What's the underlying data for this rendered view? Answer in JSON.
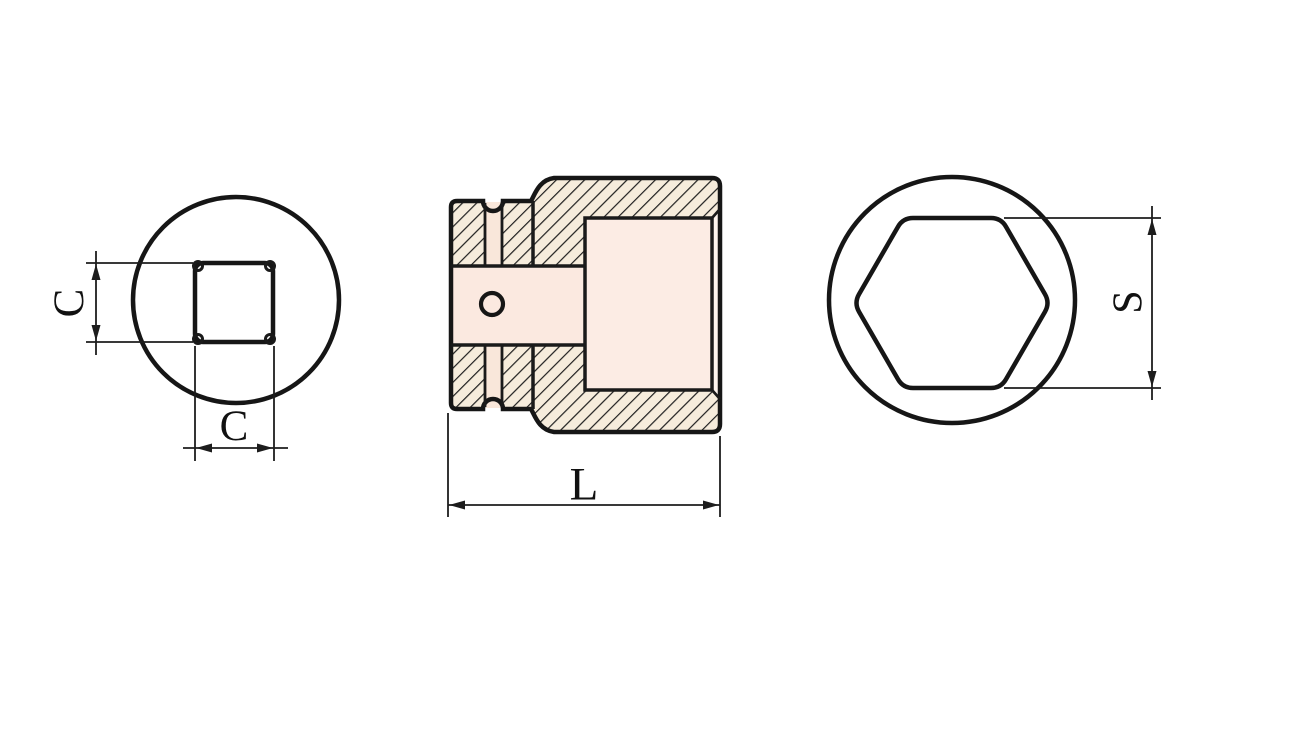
{
  "page": {
    "background_color": "#ffffff",
    "description": "Technical drawing of an impact socket: front view with square drive hole, hatched cross-section, rear view with hexagon opening"
  },
  "drawing": {
    "outline_color": "#161616",
    "dimension_line_color": "#1d1d1d",
    "hatch_line_color": "#1f1f1f",
    "hatch_background_color": "#f6ecdc",
    "body_fill_center_color": "#fdf4ed",
    "body_fill_edge_color": "#f8e2d4",
    "bore_fill_color": "#fbe9e0",
    "recess_fill_color": "#fcece4",
    "labels": {
      "front_square_height": "C",
      "front_square_width": "C",
      "section_overall_length": "L",
      "rear_hex_across_flats": "S"
    }
  }
}
